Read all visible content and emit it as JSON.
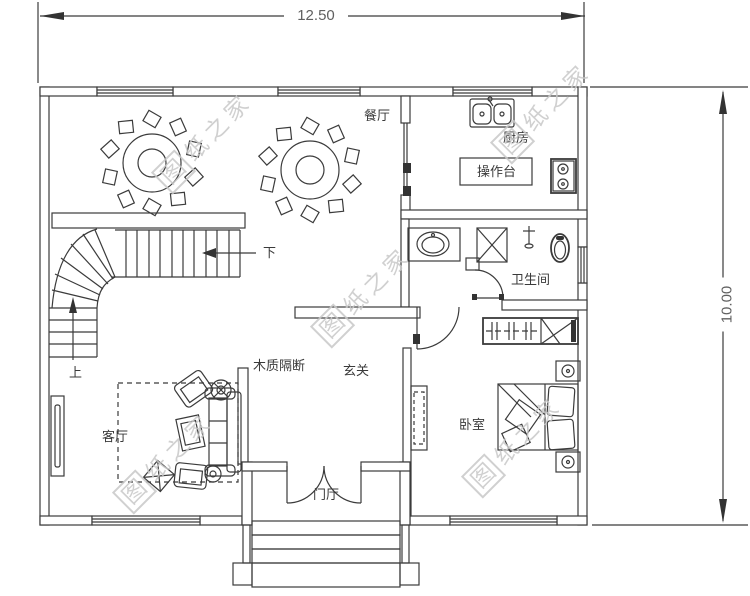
{
  "page": {
    "background": "#ffffff",
    "line_color": "#3b3b3b"
  },
  "dimensions": {
    "width": "12.50",
    "height": "10.00"
  },
  "labels": {
    "dining": "餐厅",
    "kitchen": "厨房",
    "counter": "操作台",
    "bathroom": "卫生间",
    "hallway": "玄关",
    "partition": "木质隔断",
    "living": "客厅",
    "bedroom": "卧室",
    "foyer": "门厅",
    "stairs_down": "下",
    "stairs_up": "上"
  },
  "watermark": {
    "boxed_char": "图",
    "rest": "纸之家",
    "color": "#c8c8c8"
  }
}
